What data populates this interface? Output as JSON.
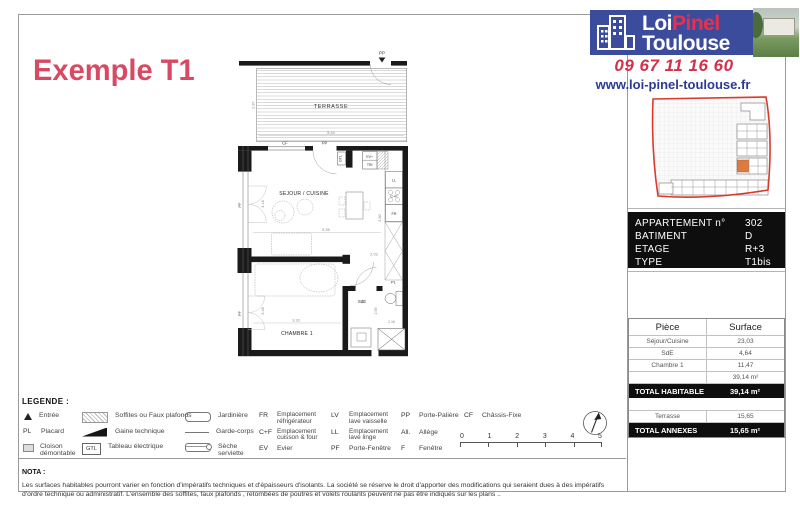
{
  "header": {
    "title": "Exemple T1",
    "logo": {
      "loi": "Loi",
      "pinel": "Pinel",
      "toulouse": "Toulouse"
    },
    "phone": "09 67 11 16 60",
    "website": "www.loi-pinel-toulouse.fr"
  },
  "colors": {
    "accent_pink": "#d84a63",
    "logo_blue": "#3c4c9c",
    "logo_red": "#e5314e",
    "map_outline_red": "#d93a2c",
    "map_highlight_orange": "#dd7a3f"
  },
  "info_panel": {
    "rows": [
      {
        "label": "APPARTEMENT n°",
        "value": "302"
      },
      {
        "label": "BATIMENT",
        "value": "D"
      },
      {
        "label": "ETAGE",
        "value": "R+3"
      },
      {
        "label": "TYPE",
        "value": "T1bis"
      }
    ]
  },
  "surface_table": {
    "col_piece": "Pièce",
    "col_surface": "Surface",
    "rows": [
      {
        "piece": "Séjour/Cuisine",
        "surface": "23,03"
      },
      {
        "piece": "SdE",
        "surface": "4,64"
      },
      {
        "piece": "Chambre 1",
        "surface": "11,47"
      },
      {
        "piece": "",
        "surface": "39,14 m²"
      }
    ],
    "total_habitable_label": "TOTAL HABITABLE",
    "total_habitable_value": "39,14 m²",
    "annexe_row": {
      "piece": "Terrasse",
      "surface": "15,65"
    },
    "total_annexes_label": "TOTAL ANNEXES",
    "total_annexes_value": "15,65 m²"
  },
  "plan": {
    "rooms": {
      "terrasse": "TERRASSE",
      "sejour": "SEJOUR / CUISINE",
      "chambre": "CHAMBRE 1",
      "sde": "SdE"
    },
    "labels": {
      "pp_terrasse": "PP",
      "cf": "CF",
      "pp_entree": "PP",
      "gtl": "GTL",
      "ev": "EV+",
      "tri": "TRI",
      "ll": "LL",
      "cf_four": "C+F",
      "fr": "FR",
      "pl": "PL",
      "pf_sejour": "PF",
      "pf_chambre": "PF"
    },
    "dims": {
      "terrasse_w": "5.44",
      "terrasse_d": "2.87",
      "sejour_w": "5.55",
      "sejour_h": "4.80",
      "sejour_left": "3.18",
      "chambre_w": "3.33",
      "chambre_h": "3.48",
      "entree": "2.03",
      "sde_h": "2.59",
      "sde_w": "2.16"
    }
  },
  "legend": {
    "title": "LEGENDE :",
    "col1": [
      {
        "abbr": "",
        "label": "Entrée"
      },
      {
        "abbr": "PL",
        "label": "Placard"
      },
      {
        "abbr": "",
        "label": "Cloison démontable"
      }
    ],
    "col2": [
      {
        "label": "Soffites ou Faux plafonds"
      },
      {
        "label": "Gaine technique"
      },
      {
        "abbr": "GTL",
        "label": "Tableau électrique"
      }
    ],
    "col3": [
      {
        "label": "Jardinière"
      },
      {
        "label": "Garde-corps"
      },
      {
        "label": "Sèche serviette"
      }
    ],
    "col4": [
      {
        "abbr": "FR",
        "label": "Emplacement réfrigérateur"
      },
      {
        "abbr": "C+F",
        "label": "Emplacement cuisson & four"
      },
      {
        "abbr": "EV",
        "label": "Evier"
      }
    ],
    "col5": [
      {
        "abbr": "LV",
        "label": "Emplacement lave vaisselle"
      },
      {
        "abbr": "LL",
        "label": "Emplacement lave linge"
      },
      {
        "abbr": "PF",
        "label": "Porte-Fenêtre"
      }
    ],
    "col6": [
      {
        "abbr": "PP",
        "label": "Porte-Palière"
      },
      {
        "abbr": "All.",
        "label": "Allège"
      },
      {
        "abbr": "F",
        "label": "Fenêtre"
      }
    ],
    "col7": [
      {
        "abbr": "CF",
        "label": "Châssis-Fixe"
      }
    ]
  },
  "scale": {
    "ticks": [
      "0",
      "1",
      "2",
      "3",
      "4",
      "5"
    ]
  },
  "nota": {
    "title": "NOTA :",
    "text": "Les surfaces habitables pourront varier en fonction d'impératifs techniques et d'épaisseurs d'isolants. La société se réserve le droit d'apporter des modifications qui seraient dues à des impératifs d'ordre technique ou administratif. L'ensemble des soffites, faux plafonds , retombées de poutres et volets roulants peuvent ne pas être indiqués sur les plans .."
  }
}
